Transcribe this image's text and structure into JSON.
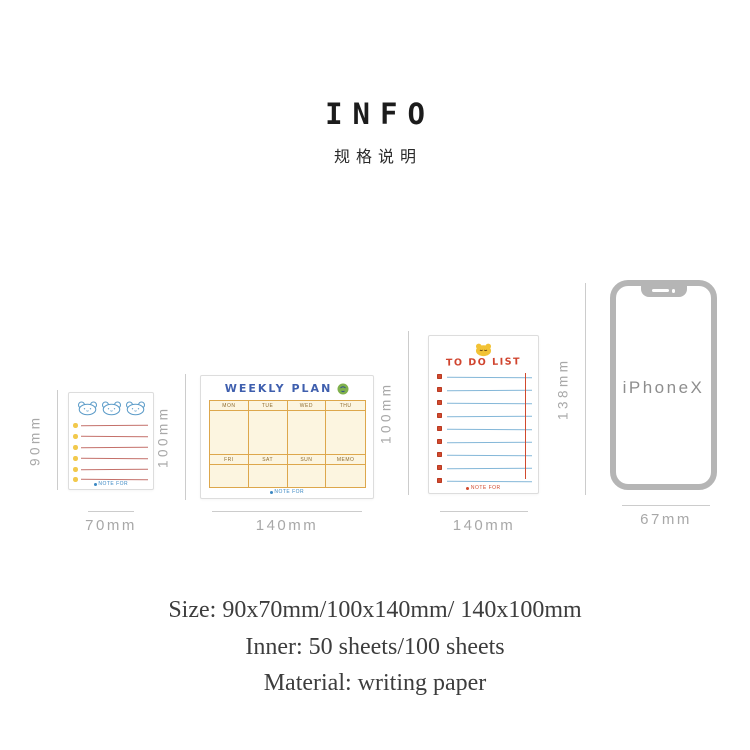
{
  "header": {
    "title": "INFO",
    "subtitle": "规格说明"
  },
  "memo": {
    "v_label": "90mm",
    "h_label": "70mm",
    "note": "NOTE FOR"
  },
  "weekly": {
    "v_label": "100mm",
    "h_label": "140mm",
    "title": "WEEKLY PLAN",
    "days1": [
      "MON",
      "TUE",
      "WED",
      "THU"
    ],
    "days2": [
      "FRI",
      "SAT",
      "SUN",
      "MEMO"
    ],
    "note": "NOTE FOR"
  },
  "todo": {
    "v_label": "100mm",
    "h_label": "140mm",
    "title": "TO DO LIST",
    "note": "NOTE FOR"
  },
  "iphone": {
    "v_label": "138mm",
    "h_label": "67mm",
    "label": "iPhoneX"
  },
  "specs": {
    "size": "Size: 90x70mm/100x140mm/ 140x100mm",
    "inner": "Inner: 50 sheets/100 sheets",
    "material": "Material: writing paper"
  },
  "colors": {
    "memo_line": "#c4706a",
    "memo_dot": "#f2c94c",
    "bear_blue": "#5b9bc8",
    "weekly_line": "#dda74c",
    "weekly_bg": "#fcf5e0",
    "weekly_title_blue": "#3f5fae",
    "todo_blue": "#84b7d8",
    "todo_red": "#d14a2e",
    "todo_yellow": "#f2c235",
    "phone_gray": "#b5b5b5",
    "dim_gray": "#a8a8a8"
  }
}
